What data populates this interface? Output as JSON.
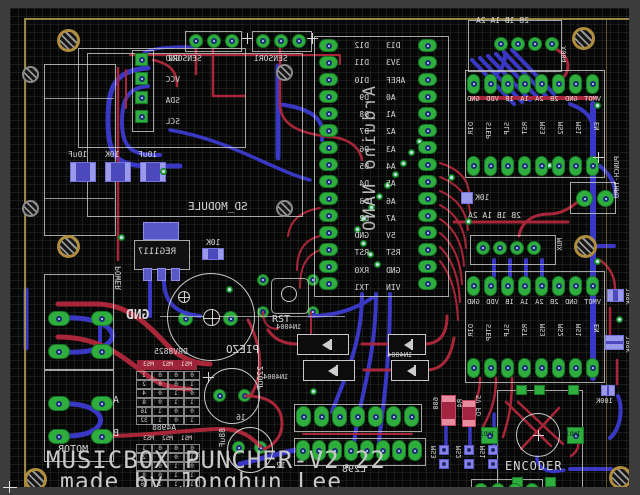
{
  "colors": {
    "margin_bg": "#3c3c3c",
    "canvas_bg": "#070707",
    "board_outline": "#a8944a",
    "trace_top": "#b2283c",
    "trace_bottom": "#3c3bcf",
    "pad_green": "#2fae3e",
    "silkscreen": "#d6d6d6"
  },
  "title_block": {
    "line1": "MUSICBOX PUNCHER-V2.22",
    "line2": "made by Jonghun Lee"
  },
  "nano": {
    "label": "Arduino NANO",
    "left_pins": [
      "D12",
      "D11",
      "D10",
      "D9",
      "D8",
      "D7",
      "D6",
      "D5",
      "D4",
      "D3",
      "D2",
      "GND",
      "RST",
      "RX0",
      "TX1"
    ],
    "right_pins": [
      "D13",
      "3V3",
      "AREF",
      "A0",
      "A1",
      "A2",
      "A3",
      "A4",
      "A5",
      "A6",
      "A7",
      "5V",
      "RST",
      "GND",
      "VIN"
    ]
  },
  "sd": {
    "label": "SD_MODULE"
  },
  "i2c": {
    "pins": [
      "GND",
      "VCC",
      "SDA",
      "SCL"
    ]
  },
  "sensors": {
    "left": "SENSOR2",
    "right": "SENSOR1"
  },
  "drivers": {
    "output_header": "2B 1B 1A 2A",
    "power_pins": [
      "VMOT",
      "GND",
      "2B",
      "2A",
      "1A",
      "1B",
      "VDD",
      "GND"
    ],
    "logic_pins": [
      "EN",
      "MS1",
      "MS2",
      "MS3",
      "RST",
      "SLP",
      "STEP",
      "DIR"
    ],
    "pullup": "10K"
  },
  "connectors": {
    "x004": "X004",
    "mux": "MUX",
    "punch": "PUNCH-THRU",
    "motor": "MOTOR",
    "motor_a": "A",
    "motor_b": "B",
    "power": "POWER",
    "gnd": "GND",
    "l298": "L298",
    "l298_pin": "12"
  },
  "passives": {
    "cap_row": [
      "10uF",
      "10K",
      "10uF"
    ],
    "reg": "REG1117",
    "reg_pullup": "10K",
    "bulk_cap1": "220uF",
    "bulk_cap1_v": "16",
    "bulk_cap2": "88uF",
    "r680": "680",
    "r680_name": "R4",
    "r5vfd": "5V FD",
    "r100k": [
      "100K",
      "100K",
      "100K"
    ],
    "ms_jumpers": [
      "MS3",
      "MS2",
      "MS1"
    ]
  },
  "parts": {
    "piezo": "PIEZO",
    "rst": "RST",
    "diode": "1N4004",
    "encoder": "ENCODER",
    "ind_left": "IND2",
    "ind_right": "IND1"
  },
  "tables": {
    "drv8825": {
      "title": "DRV8825",
      "header": [
        "MS1",
        "MS2",
        "MS3"
      ],
      "cells": [
        "0",
        "0",
        "0",
        "1",
        "1",
        "0",
        "0",
        "2",
        "0",
        "1",
        "0",
        "4",
        "1",
        "1",
        "0",
        "8",
        "0",
        "0",
        "1",
        "16",
        "1",
        "0",
        "1",
        "32"
      ]
    },
    "a4988": {
      "title": "A4988",
      "header": [
        "MS1",
        "MS2",
        "MS3"
      ],
      "cells": [
        "0",
        "0",
        "0",
        "1",
        "1",
        "0",
        "0",
        "2",
        "0",
        "1",
        "0",
        "4",
        "1",
        "1",
        "0",
        "8",
        "1",
        "1",
        "1",
        "16"
      ]
    }
  }
}
